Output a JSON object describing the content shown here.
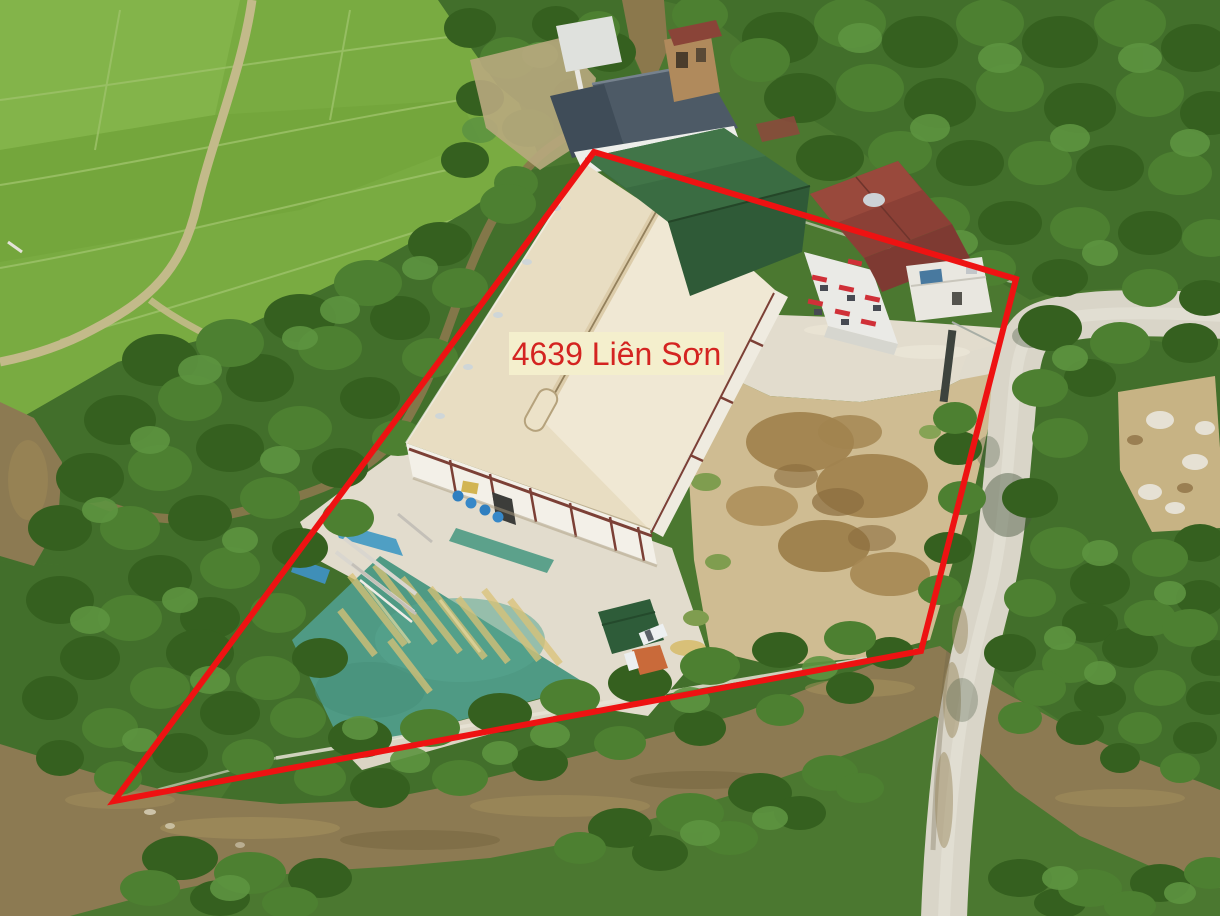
{
  "annotation": {
    "label_text": "4639 Liên Sơn",
    "label_text_color": "#d42421",
    "label_background_color": "#f4efcd",
    "boundary_color": "#ee1212",
    "boundary_points": "594,152 1016,279 921,651 114,801"
  },
  "scene": {
    "type": "aerial-drone-photo",
    "features": [
      "rice-fields",
      "tree-cover",
      "stream",
      "river",
      "gravel-road",
      "bridge",
      "warehouse",
      "green-roof-sheds",
      "house",
      "drying-yard",
      "dirt-yard",
      "blue-barrels",
      "tarp",
      "clutter"
    ],
    "colors": {
      "rice_fields": "#79ab41",
      "tree_cover": "#426f2b",
      "river_water": "#8c7a52",
      "gravel_road": "#d9d5c8",
      "warehouse_roof": "#e8ddc2",
      "drying_yard": "#4f9a84",
      "house_roof": "#8b4036",
      "bare_dirt": "#cfbc92"
    }
  }
}
